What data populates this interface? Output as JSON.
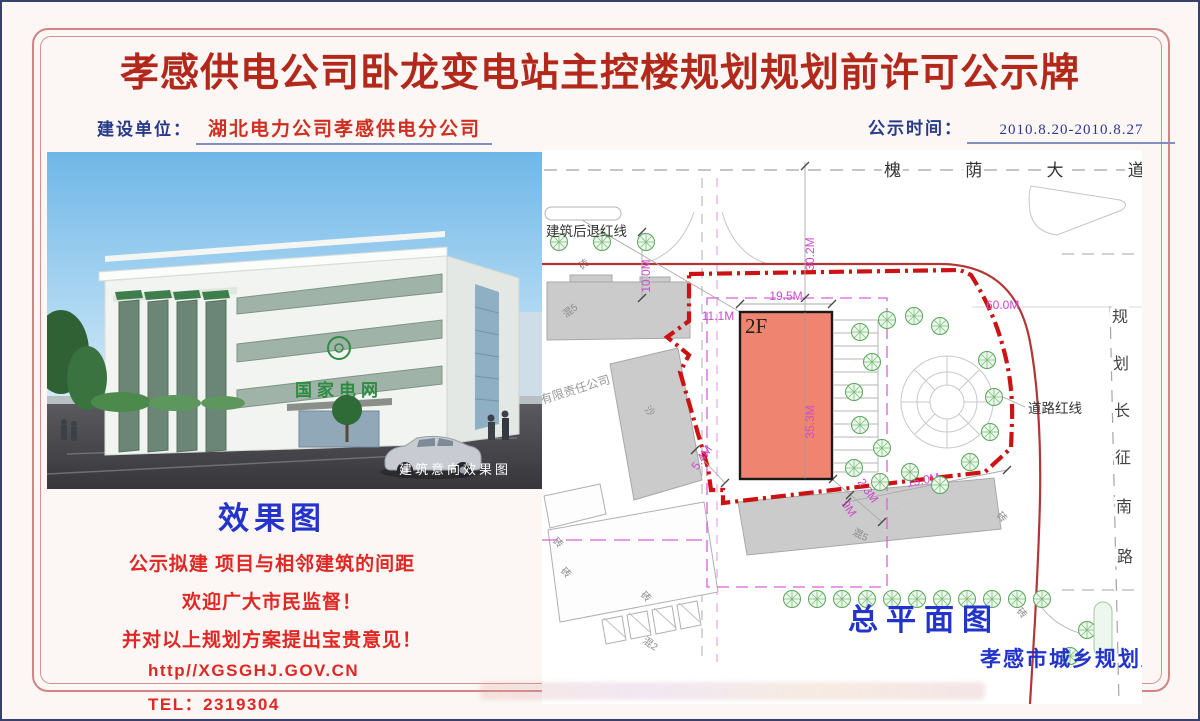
{
  "header": {
    "title": "孝感供电公司卧龙变电站主控楼规划规划前许可公示牌",
    "builder_label": "建设单位：",
    "builder_value": "湖北电力公司孝感供电分公司",
    "time_label": "公示时间：",
    "time_value": "2010.8.20-2010.8.27"
  },
  "photo": {
    "caption": "建筑意向效果图",
    "sign": "国家电网"
  },
  "notice": {
    "heading": "效果图",
    "line1": "公示拟建 项目与相邻建筑的间距",
    "line2": "欢迎广大市民监督！",
    "line3": "并对以上规划方案提出宝贵意见！",
    "website": "http//XGSGHJ.GOV.CN",
    "tel": "TEL：2319304"
  },
  "plan": {
    "road_top": "槐 荫 大 道",
    "road_right": [
      "规",
      "划",
      "长",
      "征",
      "南",
      "路"
    ],
    "setback_label": "建筑后退红线",
    "road_redline_label": "道路红线",
    "plan_title": "总平面图",
    "agency": "孝感市城乡规划局",
    "building_floors": "2F",
    "dims": {
      "north_offset": "30.2M",
      "west_setback": "10.0M",
      "building_width": "19.5M",
      "west_gap": "11.1M",
      "building_depth": "35.3M",
      "southwest_gap": "5.4M",
      "south_gap_small": "2.3M",
      "south_gap": "9M",
      "southeast_gap": "15.0M",
      "east_length": "60.0M"
    },
    "labels": {
      "hun5": "混5",
      "hun2": "混2",
      "zhuan": "砖",
      "sha": "沙",
      "company": "有限责任公司"
    }
  },
  "colors": {
    "title_red": "#b2291c",
    "heading_blue": "#2334cb",
    "body_red": "#e02723",
    "label_navy": "#273a8a",
    "value_red": "#cf2f21",
    "boundary_red": "#cc1212",
    "roadline_red": "#b23636",
    "dimension_magenta": "#cc4ccc",
    "building_fill": "#ef8570"
  }
}
